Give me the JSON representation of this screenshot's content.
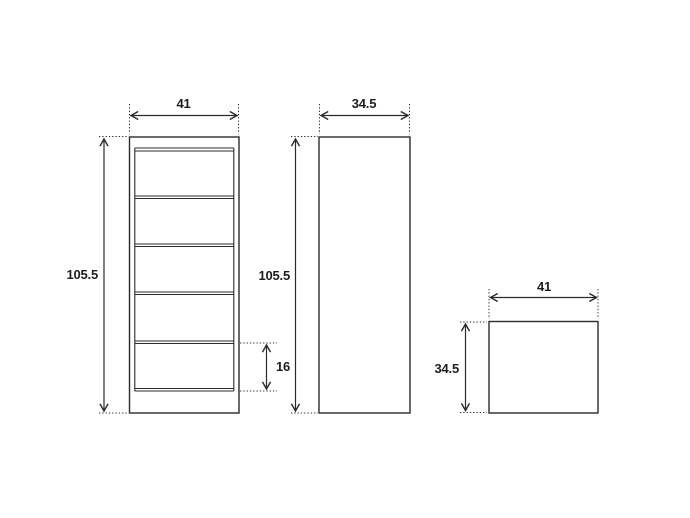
{
  "page": {
    "background_color": "#ffffff"
  },
  "drawing": {
    "type": "furniture-dimension-drawing",
    "line_color": "#2b2b2b",
    "text_color": "#1e1e1e",
    "unit_system": "cm (implied, unlabeled)",
    "views": {
      "front": {
        "label": "front-view-5-drawer-chest",
        "width": "41",
        "height": "105.5",
        "bottom_drawer_height": "16",
        "drawer_count": 5
      },
      "side": {
        "label": "side-view",
        "width": "34.5",
        "height": "105.5"
      },
      "top": {
        "label": "top-view",
        "width": "41",
        "depth": "34.5"
      }
    }
  }
}
